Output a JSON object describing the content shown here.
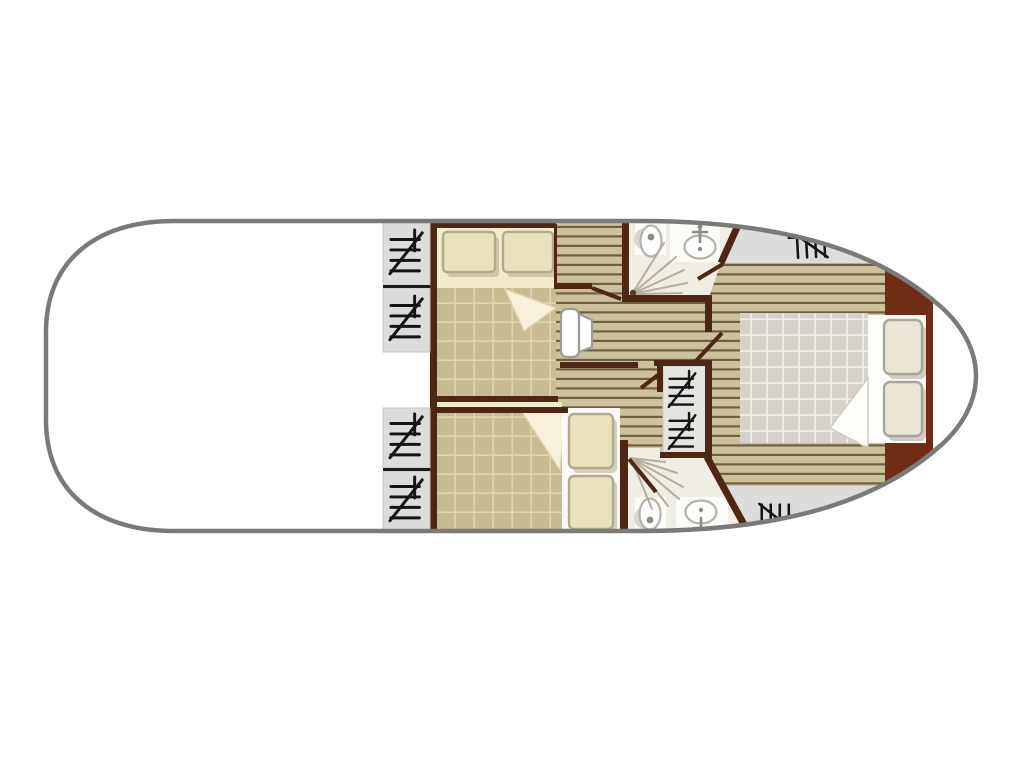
{
  "image": {
    "kind": "houseboat-floor-plan",
    "view": "top-down deck plan, bow pointing right, no text labels",
    "width_px": 1024,
    "height_px": 768
  },
  "inventory": {
    "hull": "rounded stern (left), pointed bow (right), open white saloon/deck area on the left half",
    "cabins": [
      {
        "name": "fore cabin upper",
        "bed": "double bed, 2 pillows left-top, tan gridded quilt, folded sheet corner"
      },
      {
        "name": "fore cabin lower",
        "bed": "double bed, 2 pillows at right, tan gridded quilt, folded sheet corner"
      },
      {
        "name": "aft cabin at bow",
        "bed": "double bed, 2 pillows at right, grey gridded quilt, folded sheet corner, red-brown head bulkhead"
      }
    ],
    "bathrooms": [
      {
        "name": "upper shower room",
        "fixtures": [
          "toilet",
          "washbasin",
          "shower spray"
        ]
      },
      {
        "name": "lower shower room",
        "fixtures": [
          "toilet",
          "washbasin",
          "shower spray"
        ]
      }
    ],
    "steps_icons_count": 8,
    "other": [
      "central companionway steps strip",
      "small white seat in corridor",
      "wood plank flooring in corridors and aft cabin",
      "grey side-deck wedges at bow"
    ]
  },
  "colors": {
    "hull": "#7a7a7a",
    "deck": "#dcdcda",
    "plank": "#cdc19c",
    "plankLine": "#6d6144",
    "wall": "#4e2714",
    "bow": "#702d15",
    "quiltTan": "#c8bb92",
    "quiltLine": "#ded4ae",
    "sheet": "#f1ebca",
    "sheetFold": "#f6f1d8",
    "pillow": "#e9e2bd",
    "pillowEdge": "#b2aa8a",
    "aftQuilt": "#d6d1c9",
    "aftQuiltLine": "#eeede9",
    "aftSheet": "#fdfdfa",
    "aftPillow": "#eae5d6",
    "aftPillowEdge": "#a9a59b",
    "bathFloor": "#f0ede4",
    "bathPanel": "#fbfbf8",
    "fixtureEdge": "#b5b2ab",
    "fixtureDot": "#8f8c85",
    "spray": "#b7ad9f",
    "stairs": "#e4e4e1",
    "iconBlack": "#141414",
    "benchEdge": "#9b9b97"
  }
}
